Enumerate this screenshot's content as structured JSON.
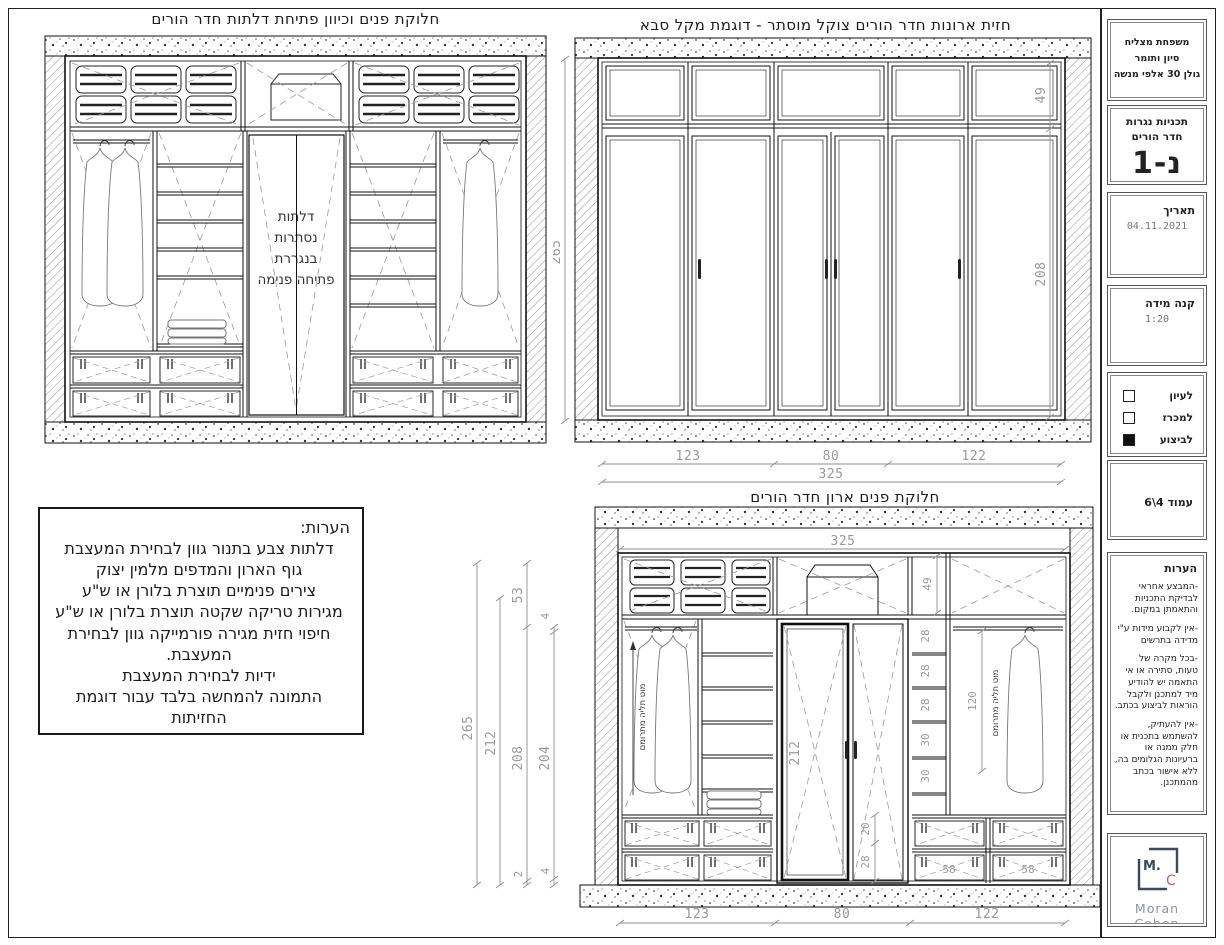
{
  "titles": {
    "interior_plan": "חלוקת פנים וכיוון פתיחת דלתות חדר הורים",
    "front_elevation": "חזית ארונות חדר הורים צוקל מוסתר - דוגמת מקל סבא",
    "interior_front": "חלוקת פנים ארון חדר הורים"
  },
  "interior_plan": {
    "door_note_lines": [
      "דלתות",
      "נסתרות",
      "בנגררת",
      "פתיחה פנימה"
    ]
  },
  "front_elevation": {
    "dim_total_height": "265",
    "dim_transom_height": "49",
    "dim_door_height": "208",
    "dim_sections": [
      "123",
      "80",
      "122"
    ],
    "dim_total_width": "325"
  },
  "interior_front": {
    "dim_total_width_top": "325",
    "dim_left": [
      "265",
      "212",
      "208",
      "204"
    ],
    "dim_left_small_top": [
      "53",
      "4"
    ],
    "dim_left_small_bottom": [
      "2",
      "4"
    ],
    "dim_top_row_height": "49",
    "dim_shelves": [
      "28",
      "28",
      "28",
      "30",
      "30"
    ],
    "dim_rod_clearance": "120",
    "rod_label_left": "מוט תליה מתרומם",
    "rod_label_right": "מוט תליה מתרומם",
    "dim_door_height": "212",
    "dim_door_small": [
      "20",
      "28"
    ],
    "dim_drawers": [
      "58",
      "58"
    ],
    "dim_sections": [
      "123",
      "80",
      "122"
    ]
  },
  "notes_box": {
    "title": "הערות:",
    "lines": [
      "דלתות צבע בתנור גוון לבחירת המעצבת",
      "גוף הארון והמדפים מלמין יצוק",
      "צירים פנימיים תוצרת בלורן או ש\"ע",
      "מגירות טריקה שקטה תוצרת בלורן או ש\"ע",
      "חיפוי חזית מגירה פורמייקה גוון לבחירת המעצבת.",
      "ידיות לבחירת המעצבת",
      "התמונה להמחשה בלבד עבור דוגמת החזיתות"
    ]
  },
  "titleblock": {
    "project": {
      "line1": "משפחת מצליח",
      "line2": "סיון ותומר",
      "line3": "גולן 30 אלפי מנשה"
    },
    "plan": {
      "title": "תכניות נגרות",
      "subtitle": "חדר הורים",
      "code": "נ-1"
    },
    "date": {
      "label": "תאריך",
      "value": "04.11.2021"
    },
    "scale": {
      "label": "קנה מידה",
      "value": "1:20"
    },
    "status": {
      "options": [
        {
          "label": "לעיון",
          "checked": false
        },
        {
          "label": "למכרז",
          "checked": false
        },
        {
          "label": "לביצוע",
          "checked": true
        }
      ]
    },
    "page": "עמוד 4\\6",
    "notes": {
      "title": "הערות",
      "items": [
        "-המבצע אחראי לבדיקת התכניות והתאמתן במקום.",
        "-אין לקבוע מידות ע\"י מדידה בתרשים",
        "-בכל מקרה של טעות, סתירה או אי התאמה יש להודיע מיד למתכנן ולקבל הוראות לביצוע בכתב.",
        "-אין להעתיק, להשתמש בתכנית או חלק ממנה או ברעיונות הגלומים בה, ללא אישור בכתב מהמתכנן."
      ]
    },
    "logo": {
      "mark_m": "M.",
      "mark_c": "C",
      "name": "Moran Cohen",
      "tagline": "עיצוב ותיכנון פנים",
      "frame_color": "#3b4a5c",
      "c_color": "#b06a6a"
    }
  }
}
